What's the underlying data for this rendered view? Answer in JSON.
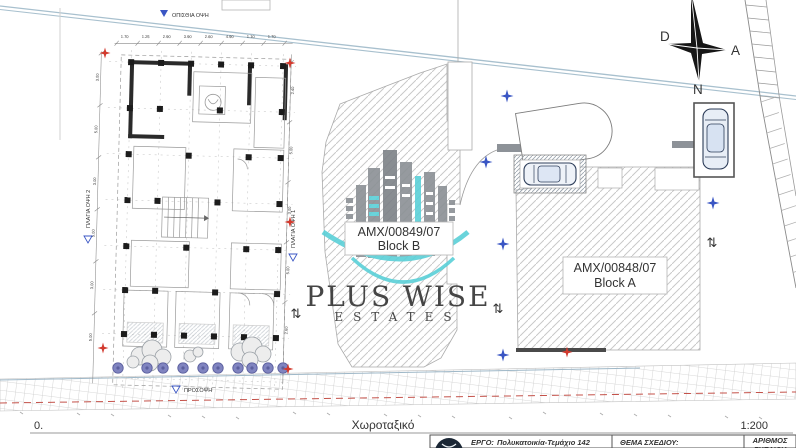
{
  "page": {
    "title": "Χωροταξικό",
    "origin": "0.",
    "scale": "1:200"
  },
  "compass": {
    "west": "D",
    "east": "A",
    "south": "N"
  },
  "blocks": [
    {
      "permit": "AMX/00849/07",
      "label": "Block B"
    },
    {
      "permit": "AMX/00848/07",
      "label": "Block A"
    }
  ],
  "elevations": {
    "rear": "ΟΠΙΣΘΙΑ ΟΨΗ",
    "side1": "ΠΛΑΓΙΑ ΟΨΗ 1",
    "side2": "ΠΛΑΓΙΑ ΟΨΗ 2",
    "front": "ΠΡΟΣΟΨΗ"
  },
  "watermark": {
    "name": "PLUS WISE",
    "tagline": "ESTATES"
  },
  "titleblock": {
    "project_label": "ΕΡΓΟ:",
    "project_value": "Πολυκατοικία-Τεμάχιο 142",
    "subject_label": "ΘΕΜΑ ΣΧΕΔΙΟΥ:",
    "number_label_line1": "ΑΡΙΘΜΟΣ",
    "number_label_line2": "ΣΧΕΔΙΟΥ"
  },
  "annotations": {
    "two_way_arrow_glyph": "⇅",
    "arrow_positions": [
      [
        296,
        318
      ],
      [
        498,
        313
      ],
      [
        712,
        247
      ]
    ],
    "blue_stars": [
      [
        507,
        96
      ],
      [
        486,
        162
      ],
      [
        503,
        244
      ],
      [
        503,
        355
      ],
      [
        713,
        203
      ]
    ],
    "red_stars": [
      [
        105,
        53
      ],
      [
        290,
        63
      ],
      [
        290,
        222
      ],
      [
        103,
        348
      ],
      [
        288,
        369
      ],
      [
        567,
        352
      ]
    ],
    "bushes_x": [
      118,
      147,
      163,
      183,
      203,
      218,
      238,
      252,
      268,
      283
    ],
    "bushes_y": 368
  },
  "dimensions": {
    "top": [
      "1.70",
      "1.25",
      "2.90",
      "3.90",
      "2.60",
      "4.90",
      "1.10",
      "1.70"
    ],
    "left": [
      "3.00",
      "5.00",
      "3.00",
      "5.00",
      "3.00",
      "5.00"
    ],
    "right": [
      "2.40",
      "5.00",
      "3.00",
      "5.00",
      "2.60"
    ]
  },
  "colors": {
    "boundary": "#a8c0ce",
    "annotation_blue": "#3a56c4",
    "marker_red": "#d23a2e",
    "hatch": "#c9c9c9",
    "watermark_gray": "#8b9095",
    "watermark_teal": "#5ad0d8",
    "road_red": "#c4524a"
  }
}
